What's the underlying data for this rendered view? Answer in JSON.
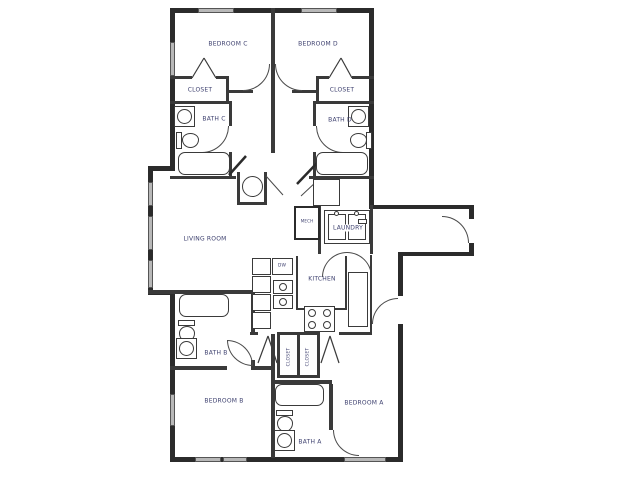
{
  "drawing": {
    "type": "apartment-floor-plan",
    "labels": {
      "bedroom_a": "BEDROOM A",
      "bedroom_b": "BEDROOM B",
      "bedroom_c": "BEDROOM C",
      "bedroom_d": "BEDROOM D",
      "bath_a": "BATH A",
      "bath_b": "BATH B",
      "bath_c": "BATH C",
      "bath_d": "BATH D",
      "closet_c": "CLOSET",
      "closet_d": "CLOSET",
      "closet_hall_1": "CLOSET",
      "closet_hall_2": "CLOSET",
      "living_room": "LIVING ROOM",
      "kitchen": "KITCHEN",
      "laundry": "LAUNDRY",
      "dishwasher": "DW",
      "mech": "MECH"
    },
    "colors": {
      "background": "#ffffff",
      "wall": "#2b2b2b",
      "label_text": "#3c3f6e",
      "window_fill": "#b8b8b8",
      "fixture_line": "#3a3a3a"
    }
  }
}
